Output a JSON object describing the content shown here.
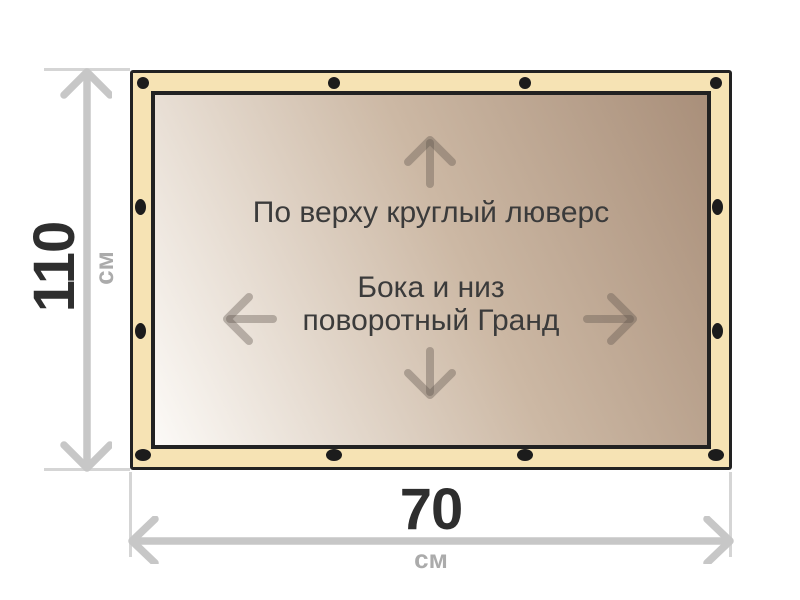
{
  "banner": {
    "top_note": "По верху круглый люверс",
    "center_note_line1": "Бока и низ",
    "center_note_line2": "поворотный Гранд"
  },
  "height_dimension": {
    "value": "110",
    "unit": "см"
  },
  "width_dimension": {
    "value": "70",
    "unit": "см"
  },
  "colors": {
    "edge_band": "#f6e3b4",
    "frame_border": "#222222",
    "grommet": "#1c1c1c",
    "canvas_gradient_light": "#fcfaf7",
    "canvas_gradient_dark": "#a98f7a",
    "note_text": "#3b3b3b",
    "inner_arrow": "#a29282",
    "dimension_value_text": "#2e2e2e",
    "dimension_unit_text": "#ababab",
    "dimension_arrow": "#c7c7c7",
    "extension_line": "#d5d5d5"
  }
}
